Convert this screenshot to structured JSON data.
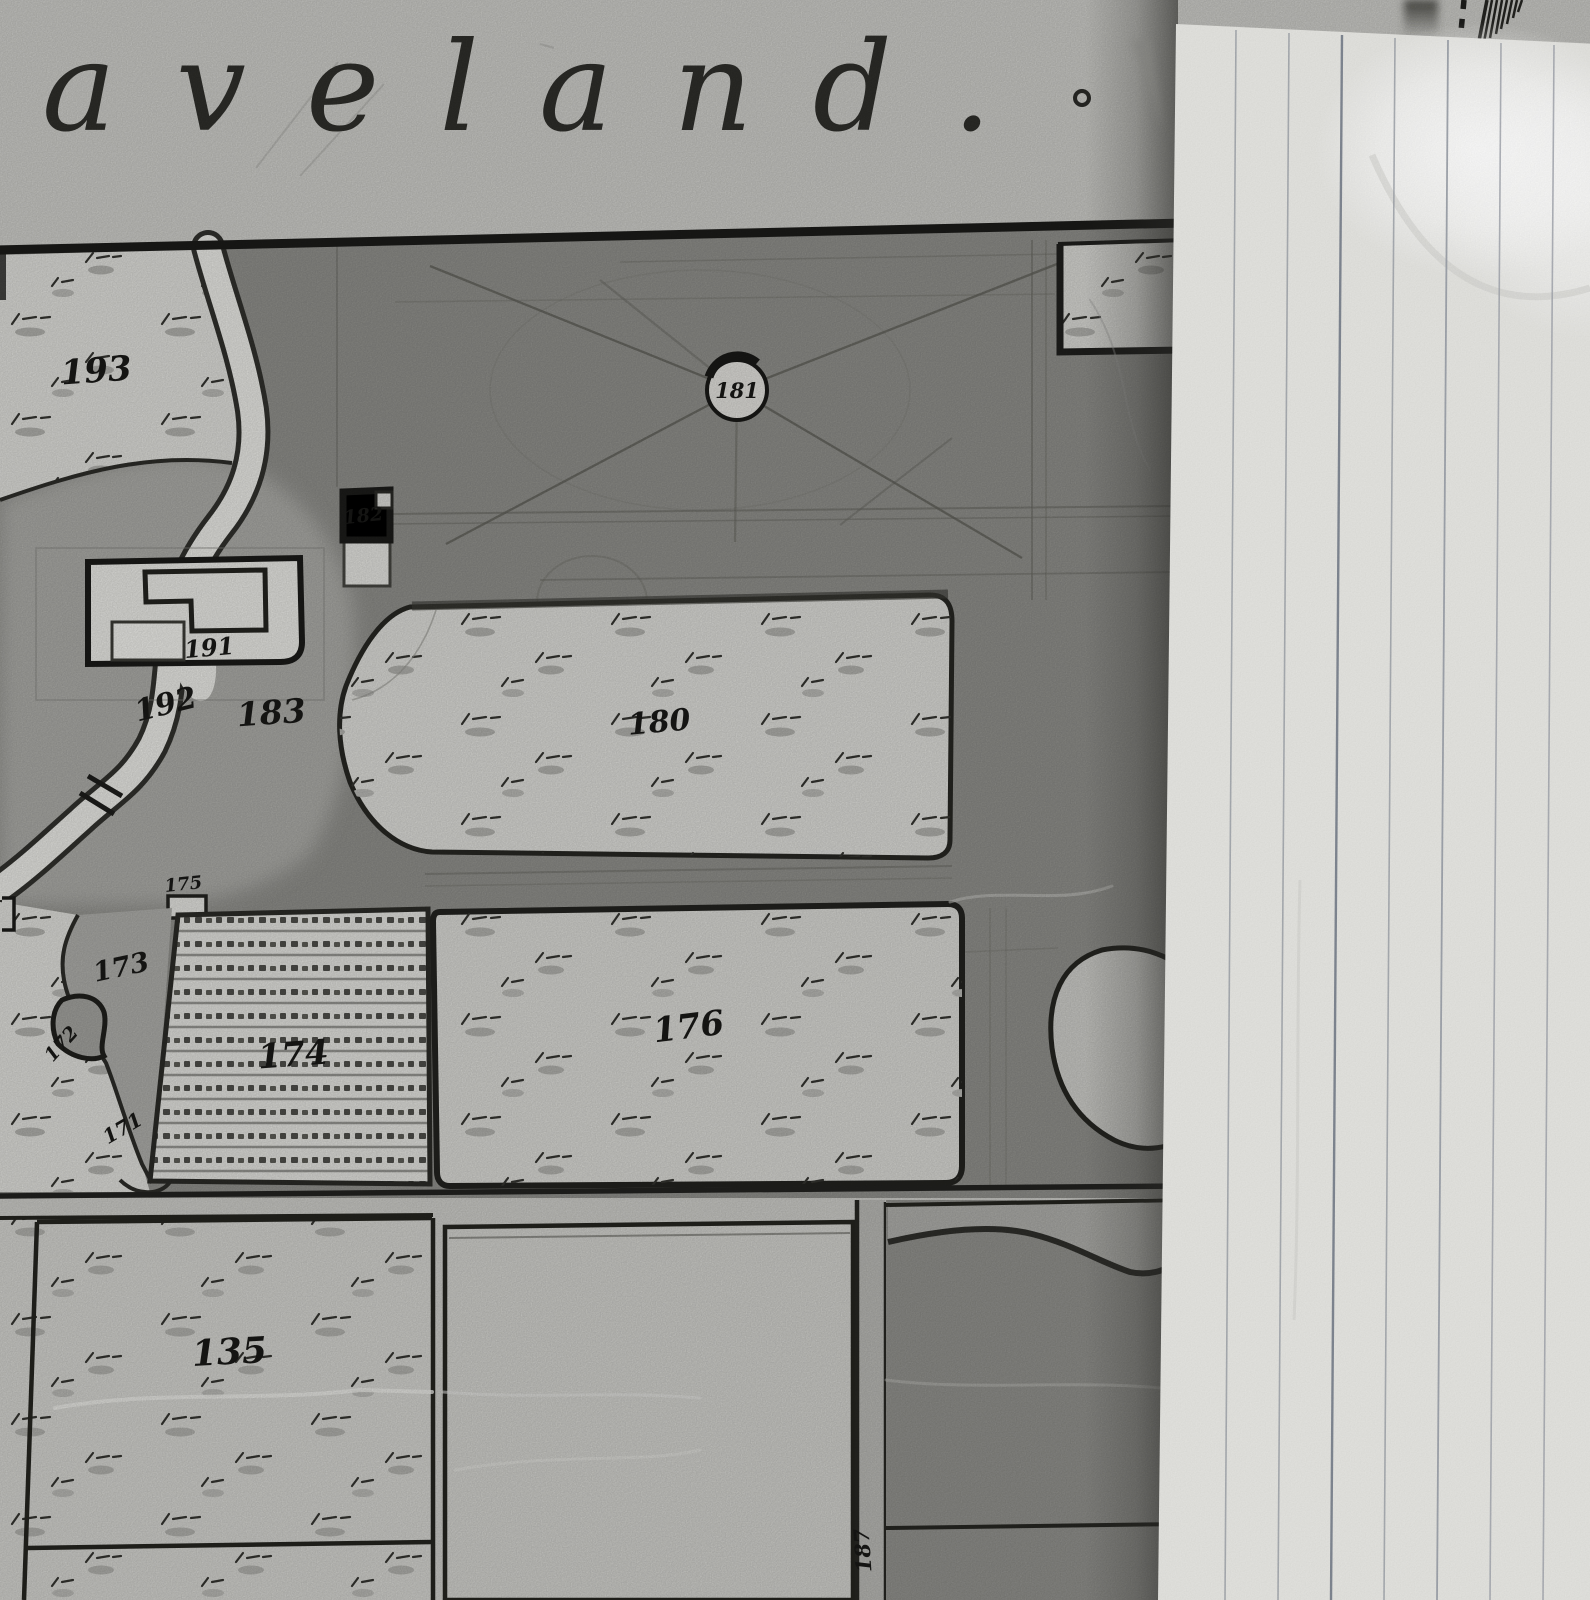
{
  "photo": {
    "map_title": "aveland."
  },
  "map": {
    "parcel_labels": [
      {
        "id": "193",
        "text": "193"
      },
      {
        "id": "181",
        "text": "181"
      },
      {
        "id": "182",
        "text": "182"
      },
      {
        "id": "191",
        "text": "191"
      },
      {
        "id": "192",
        "text": "192"
      },
      {
        "id": "183",
        "text": "183"
      },
      {
        "id": "180",
        "text": "180"
      },
      {
        "id": "175",
        "text": "175"
      },
      {
        "id": "173",
        "text": "173"
      },
      {
        "id": "172",
        "text": "172"
      },
      {
        "id": "174",
        "text": "174"
      },
      {
        "id": "171",
        "text": "171"
      },
      {
        "id": "176",
        "text": "176"
      },
      {
        "id": "135",
        "text": "135"
      },
      {
        "id": "187",
        "text": "187"
      }
    ]
  },
  "colors": {
    "sheet_margin": "#c7c7c3",
    "woodland_dark": "#8b8b87",
    "midland_gray": "#a5a5a1",
    "parcel_light": "#d6d6d2",
    "ink": "#1b1b19",
    "notepaper": "#e8e8e4"
  }
}
